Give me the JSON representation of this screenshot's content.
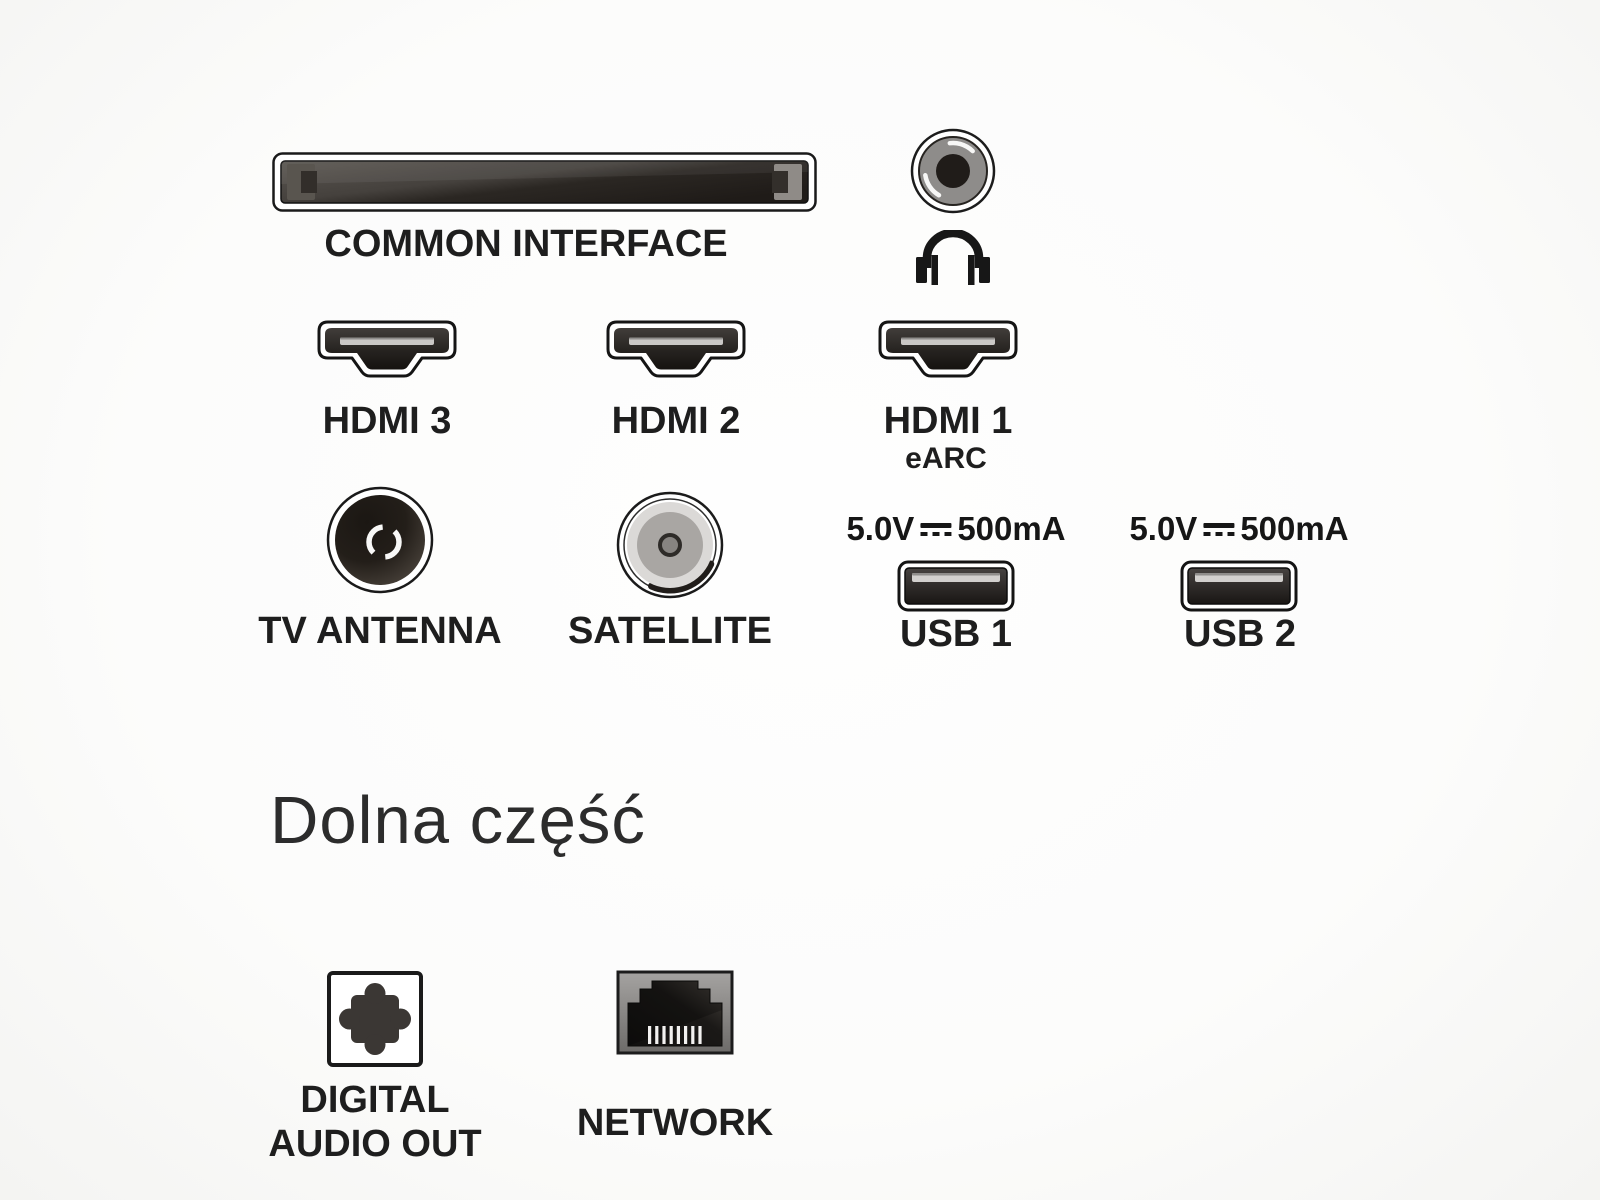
{
  "colors": {
    "text": "#1d1d1d",
    "port_dark": "#2b2724",
    "port_metal_gray": "#a8a6a4",
    "background": "#fcfcfb"
  },
  "rear_panel": {
    "common_interface": {
      "label": "COMMON INTERFACE"
    },
    "headphone_jack": {
      "icon": "headphones-icon"
    },
    "hdmi_ports": [
      {
        "label": "HDMI 3",
        "sublabel": ""
      },
      {
        "label": "HDMI 2",
        "sublabel": ""
      },
      {
        "label": "HDMI 1",
        "sublabel": "eARC"
      }
    ],
    "tv_antenna": {
      "label": "TV ANTENNA"
    },
    "satellite": {
      "label": "SATELLITE"
    },
    "usb_ports": [
      {
        "label": "USB 1",
        "voltage": "5.0V",
        "current": "500mA",
        "dc_symbol": "dc-voltage-icon"
      },
      {
        "label": "USB 2",
        "voltage": "5.0V",
        "current": "500mA",
        "dc_symbol": "dc-voltage-icon"
      }
    ]
  },
  "bottom_panel": {
    "heading": "Dolna część",
    "digital_audio_out": {
      "label_line1": "DIGITAL",
      "label_line2": "AUDIO OUT"
    },
    "network": {
      "label": "NETWORK"
    }
  }
}
